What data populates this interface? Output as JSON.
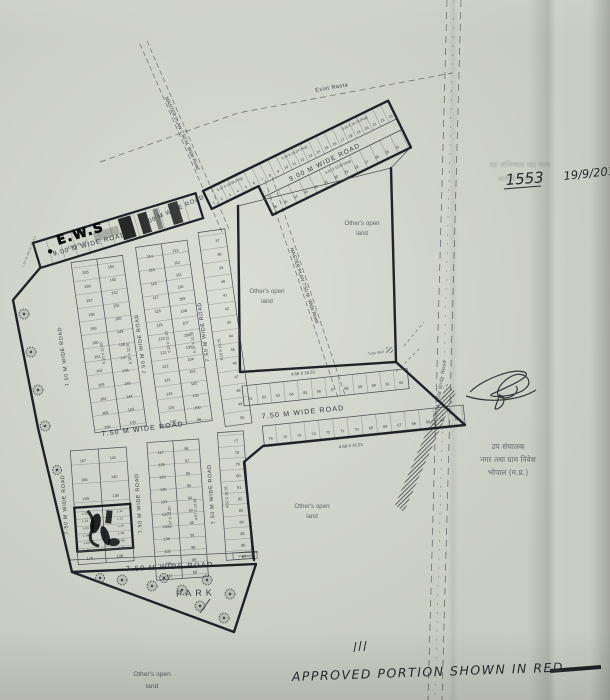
{
  "roads": {
    "w9": "9.00 M WIDE ROAD",
    "w75": "7.50 M WIDE ROAD",
    "master": "MASTER PLAN 7.50 M. Wide Road",
    "exist_rasta": "Exist Rasta",
    "exist24": "Exist.24.00M Wide Road"
  },
  "labels": {
    "ews_marker": "E.W.S",
    "ews_plot": "EWS PLOT",
    "open1": "Other's open",
    "open2": "land",
    "park": "PARK",
    "pathway": "Pathway",
    "tube_well": "Tube Well"
  },
  "dims": {
    "d1358": "6.10 X 13.58 (Avg)",
    "d1524": "6.10 X 15.24 (Avg)",
    "d1610": "6.10 X 16.10 (Avg)",
    "d1300": "6.10 X 13.00 (Avg)",
    "d1220": "6.10 X 12.20",
    "d1375": "6.10 X 13.75",
    "d1623": "4.58 X 16.23",
    "d457": "4.57 X 12.20",
    "d452": "4.52 X 13.78"
  },
  "plots": {
    "strip_row1": [
      "1",
      "2",
      "3",
      "4",
      "5",
      "6",
      "7",
      "8",
      "9",
      "10",
      "11",
      "12",
      "13",
      "14",
      "15",
      "16",
      "17",
      "18",
      "19",
      "20",
      "21",
      "22",
      "23"
    ],
    "strip_row2": [
      "36",
      "35",
      "34",
      "33",
      "32",
      "31",
      "30",
      "29",
      "28",
      "27",
      "26",
      "25",
      "24"
    ],
    "mid_row1": [
      "51",
      "52",
      "53",
      "54",
      "55",
      "56",
      "57",
      "58",
      "59",
      "60",
      "61",
      "62"
    ],
    "mid_row2": [
      "76",
      "75",
      "74",
      "73",
      "72",
      "71",
      "70",
      "69",
      "68",
      "67",
      "66",
      "65",
      "64",
      "63"
    ],
    "central_a_left": [
      "155",
      "156",
      "157",
      "158",
      "159",
      "160",
      "161",
      "162",
      "163",
      "164",
      "165",
      "166"
    ],
    "central_a_right": [
      "154",
      "153",
      "152",
      "151",
      "150",
      "149",
      "148",
      "147",
      "146",
      "145",
      "144",
      "143",
      "142"
    ],
    "central_b_left": [
      "114",
      "115",
      "116",
      "117",
      "118",
      "119",
      "120",
      "121",
      "122",
      "123",
      "124",
      "125",
      "126"
    ],
    "central_b_right": [
      "113",
      "112",
      "111",
      "110",
      "109",
      "108",
      "107",
      "106",
      "105",
      "104",
      "103",
      "102",
      "101",
      "100",
      "99"
    ],
    "central_c": [
      "37",
      "38",
      "39",
      "40",
      "41",
      "42",
      "43",
      "44",
      "45",
      "46",
      "47",
      "48",
      "49",
      "50"
    ],
    "lower_a_left": [
      "167",
      "168",
      "169"
    ],
    "lower_a_right": [
      "141",
      "140",
      "139"
    ],
    "lower_a_bottom": [
      "170",
      "138"
    ],
    "lig_left": [
      "L-01",
      "L-02",
      "L-03",
      "L-04",
      "L-05",
      "L-06"
    ],
    "lig_right": [
      "L-12",
      "L-11",
      "L-10",
      "L-09",
      "L-08",
      "L-07"
    ],
    "lower_b_left": [
      "127",
      "128",
      "129",
      "130",
      "131",
      "132",
      "133",
      "134",
      "135",
      "136",
      "137"
    ],
    "lower_b_right": [
      "98",
      "97",
      "96",
      "95",
      "94",
      "93",
      "92",
      "91",
      "90",
      "89",
      "88"
    ],
    "lower_c": [
      "77",
      "78",
      "79",
      "80",
      "81",
      "82",
      "83",
      "84",
      "85",
      "86",
      "87"
    ]
  },
  "annotations": {
    "serial": "1553",
    "date": "19/9/201",
    "approved": "APPROVED PORTION SHOWN IN RED",
    "stamp_line1": "उप संचालक",
    "stamp_line2": "नगर तथा ग्राम निवेश",
    "stamp_line3": "भोपाल (म.प्र.)",
    "faint1": "यह अभिन्यास खंड मान्य",
    "faint2": "शर्तों के अधीन"
  }
}
